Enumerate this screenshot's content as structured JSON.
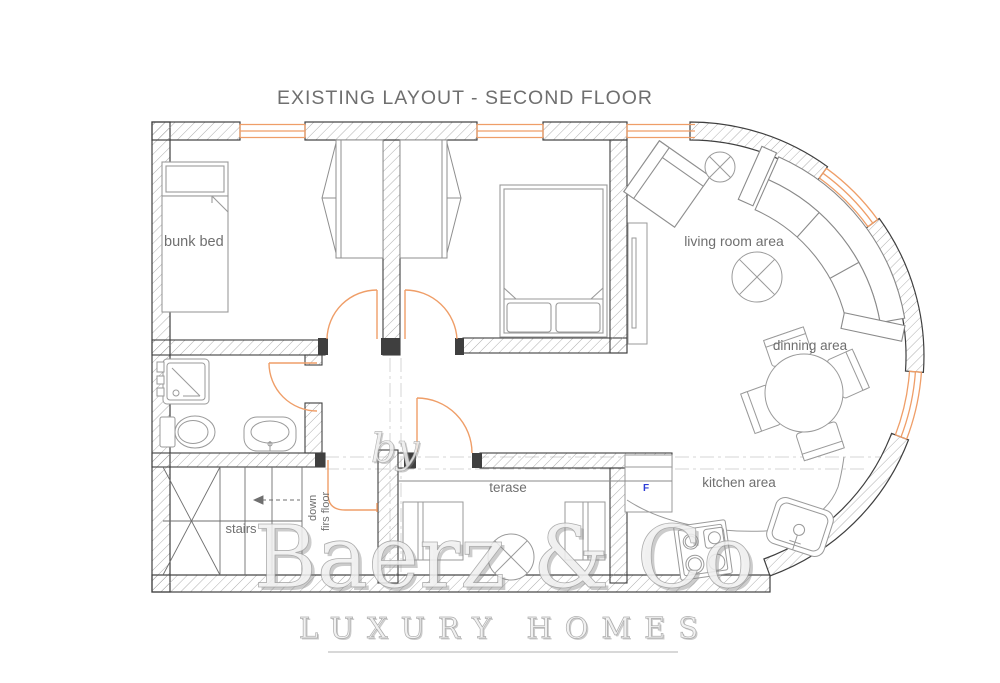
{
  "title": "EXISTING LAYOUT - SECOND FLOOR",
  "labels": {
    "bunk_bed": "bunk bed",
    "living_room": "living room area",
    "dining": "dinning area",
    "kitchen": "kitchen area",
    "terrace": "terase",
    "stairs": "stairs",
    "stairs_down_line1": "down",
    "stairs_down_line2": "firs floor",
    "fridge_marker": "F"
  },
  "watermark": {
    "prefix": "by",
    "brand": "Baerz & Co",
    "tagline": "LUXURY HOMES"
  },
  "colors": {
    "wall_line": "#3f3f3f",
    "hatch_line": "#9a9a9a",
    "window_door_orange": "#EF9E68",
    "furniture_gray": "#8f8f8f",
    "label_text": "#6f6f6f",
    "watermark_gray": "#c9c9c9",
    "fridge_marker_blue": "#2b3bd6"
  }
}
